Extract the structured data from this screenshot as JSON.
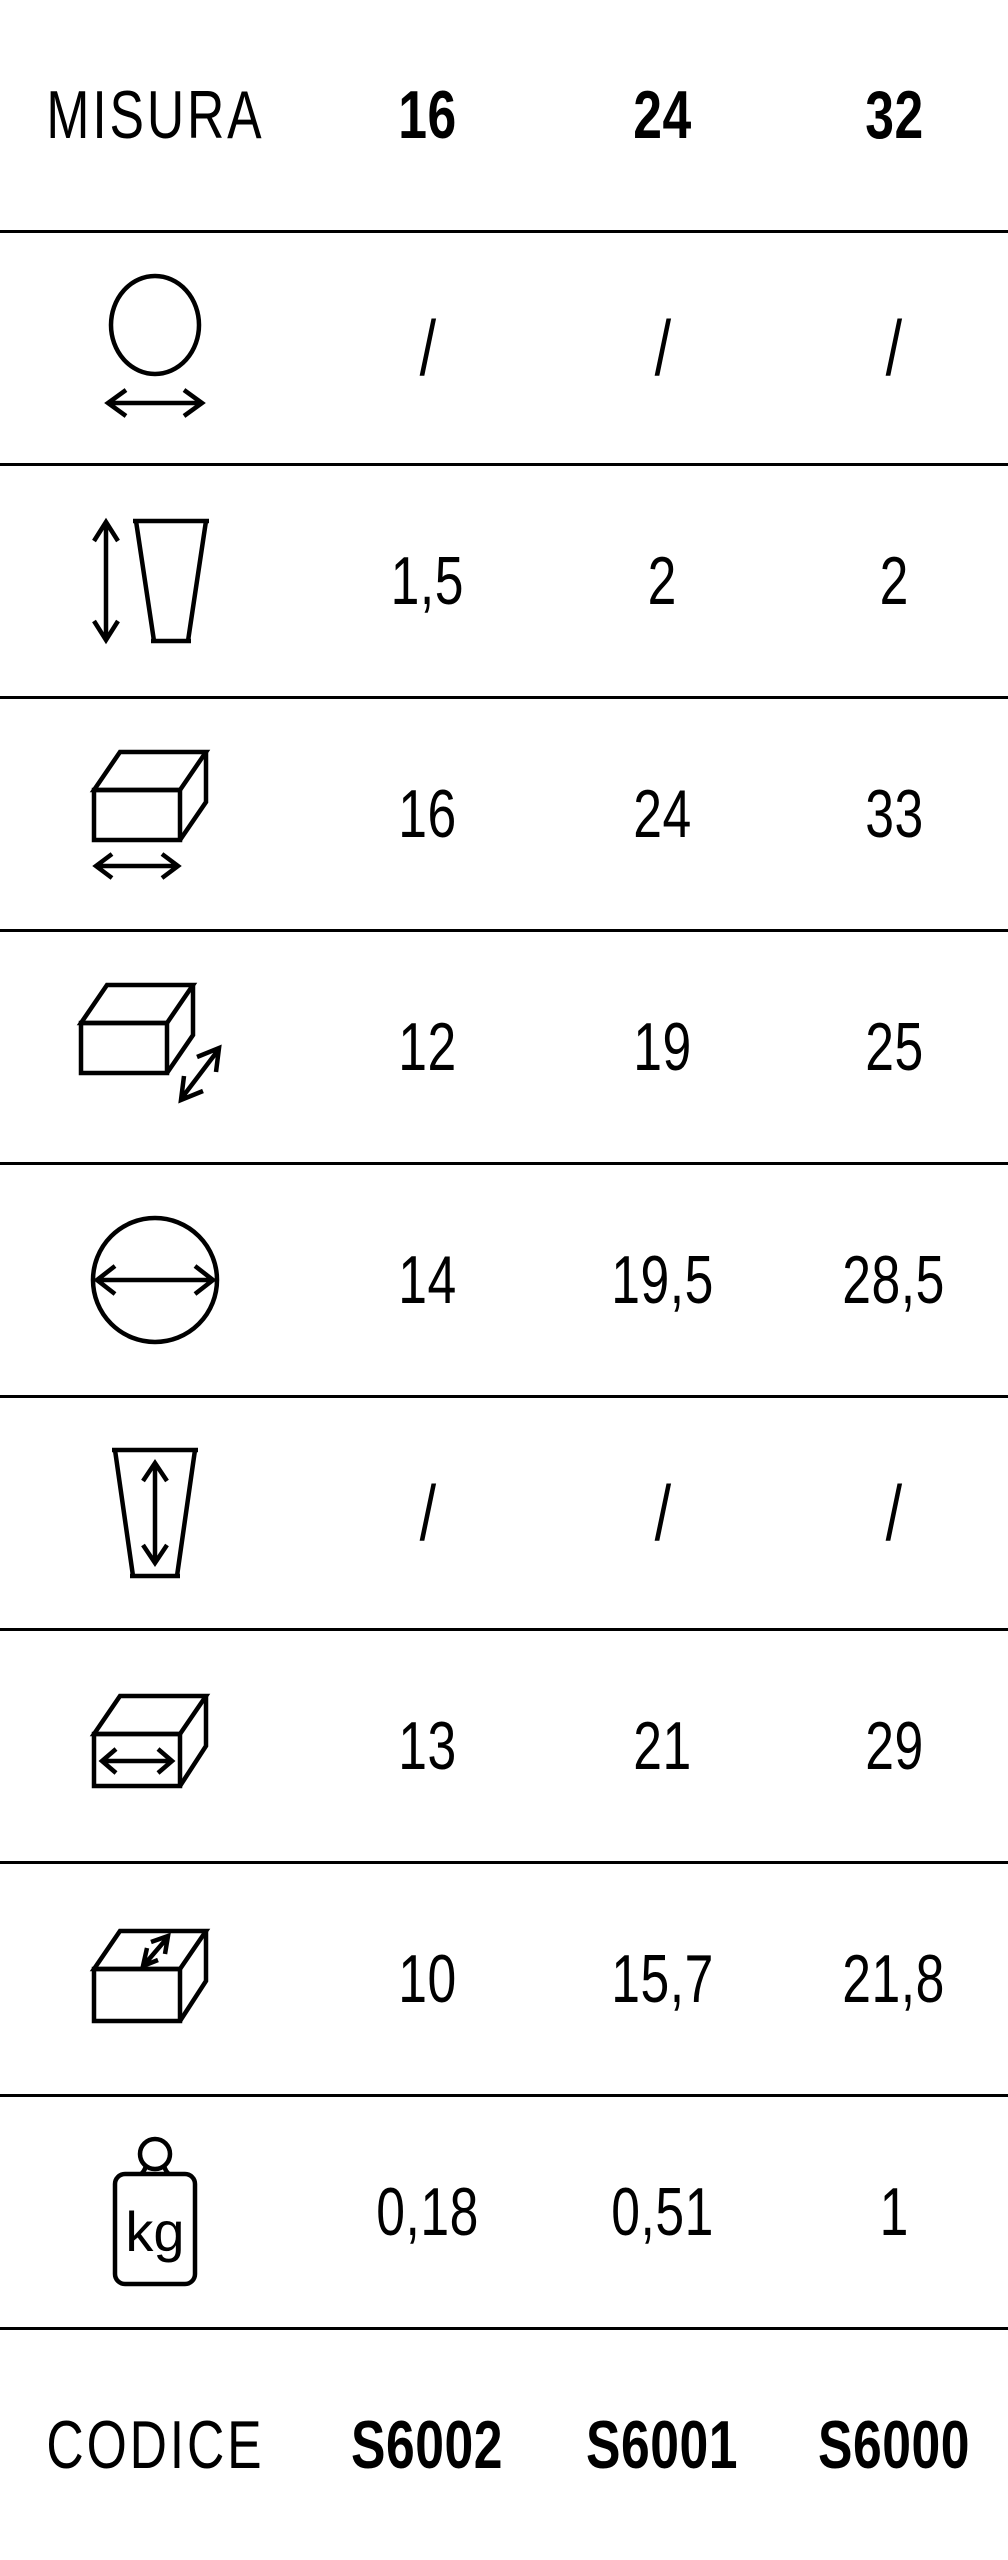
{
  "colors": {
    "background": "#ffffff",
    "text": "#000000",
    "line": "#000000"
  },
  "header": {
    "label": "MISURA",
    "sizes": [
      "16",
      "24",
      "32"
    ]
  },
  "rows": [
    {
      "icon": "ball-width-arrow-icon",
      "values": [
        "/",
        "/",
        "/"
      ]
    },
    {
      "icon": "height-arrow-taper-icon",
      "values": [
        "1,5",
        "2",
        "2"
      ]
    },
    {
      "icon": "box-width-arrow-icon",
      "values": [
        "16",
        "24",
        "33"
      ]
    },
    {
      "icon": "box-depth-arrow-icon",
      "values": [
        "12",
        "19",
        "25"
      ]
    },
    {
      "icon": "circle-diameter-icon",
      "values": [
        "14",
        "19,5",
        "28,5"
      ]
    },
    {
      "icon": "taper-height-arrow-icon",
      "values": [
        "/",
        "/",
        "/"
      ]
    },
    {
      "icon": "slab-width-arrow-icon",
      "values": [
        "13",
        "21",
        "29"
      ]
    },
    {
      "icon": "slab-depth-arrow-icon",
      "values": [
        "10",
        "15,7",
        "21,8"
      ]
    },
    {
      "icon": "weight-kg-icon",
      "icon_text": "kg",
      "values": [
        "0,18",
        "0,51",
        "1"
      ]
    }
  ],
  "footer": {
    "label": "CODICE",
    "codes": [
      "S6002",
      "S6001",
      "S6000"
    ]
  }
}
